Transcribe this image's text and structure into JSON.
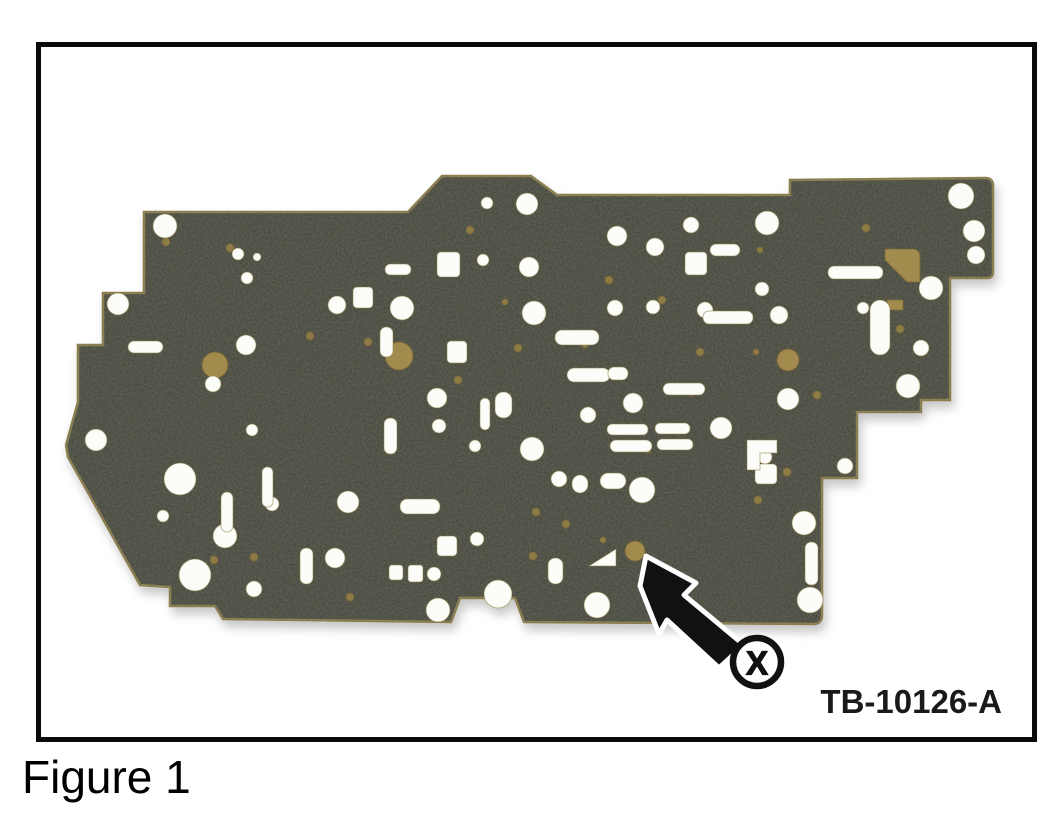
{
  "figure": {
    "caption": "Figure 1",
    "reference": "TB-10126-A"
  },
  "colors": {
    "background": "#ffffff",
    "frame": "#0a0a0a",
    "plate": "#42433a",
    "plate_edge": "#8a7c4b",
    "hole_fill": "#fcfcf9",
    "hole_stroke": "#8c7d46",
    "gold": "#a28c4d",
    "gold_dark": "#77663a",
    "gold_dot": "#8f7c45",
    "callout": "#111111",
    "callout_outline": "#ffffff"
  },
  "plate": {
    "outline": "M144,212 L408,212 L442,176 L531,176 L557,195 L790,195 L790,180 L985,178 Q993,178 993,186 L993,272 Q993,278 987,278 L950,278 L950,400 L921,400 L921,412 L857,412 L857,478 L822,478 L822,615 Q822,624 813,624 L524,622 L515,598 L460,598 L451,622 L223,619 L215,606 L170,606 L170,587 L140,585 L68,457 L66,445 L78,402 L78,345 L103,345 L103,293 L144,293 Z",
    "white_circles": [
      [
        165,
        226,
        12
      ],
      [
        118,
        304,
        11
      ],
      [
        96,
        440,
        11
      ],
      [
        246,
        345,
        10
      ],
      [
        213,
        384,
        8
      ],
      [
        238,
        254,
        6
      ],
      [
        257,
        257,
        4
      ],
      [
        247,
        278,
        6
      ],
      [
        337,
        305,
        9
      ],
      [
        402,
        308,
        12
      ],
      [
        487,
        203,
        6
      ],
      [
        527,
        204,
        11
      ],
      [
        534,
        313,
        12
      ],
      [
        483,
        260,
        6
      ],
      [
        529,
        267,
        10
      ],
      [
        617,
        236,
        10
      ],
      [
        655,
        247,
        9
      ],
      [
        691,
        225,
        8
      ],
      [
        767,
        223,
        12
      ],
      [
        762,
        289,
        7
      ],
      [
        779,
        315,
        9
      ],
      [
        863,
        308,
        6
      ],
      [
        921,
        348,
        8
      ],
      [
        961,
        196,
        13
      ],
      [
        974,
        231,
        11
      ],
      [
        976,
        255,
        9
      ],
      [
        931,
        288,
        12
      ],
      [
        908,
        386,
        12
      ],
      [
        788,
        399,
        11
      ],
      [
        845,
        466,
        8
      ],
      [
        804,
        523,
        12
      ],
      [
        810,
        600,
        13
      ],
      [
        437,
        398,
        10
      ],
      [
        439,
        426,
        7
      ],
      [
        475,
        446,
        6
      ],
      [
        588,
        415,
        8
      ],
      [
        633,
        403,
        10
      ],
      [
        653,
        307,
        7
      ],
      [
        705,
        310,
        8
      ],
      [
        615,
        308,
        8
      ],
      [
        532,
        449,
        12
      ],
      [
        559,
        479,
        8
      ],
      [
        642,
        490,
        13
      ],
      [
        721,
        428,
        11
      ],
      [
        765,
        457,
        7
      ],
      [
        180,
        479,
        16
      ],
      [
        195,
        575,
        16
      ],
      [
        225,
        536,
        12
      ],
      [
        272,
        504,
        7
      ],
      [
        335,
        558,
        10
      ],
      [
        348,
        502,
        11
      ],
      [
        252,
        430,
        6
      ],
      [
        163,
        516,
        6
      ],
      [
        254,
        589,
        8
      ],
      [
        498,
        594,
        14
      ],
      [
        438,
        610,
        12
      ],
      [
        597,
        605,
        13
      ],
      [
        477,
        539,
        7
      ],
      [
        434,
        574,
        7
      ]
    ],
    "slots": [
      [
        710,
        244,
        30,
        12,
        6
      ],
      [
        828,
        266,
        55,
        13,
        6
      ],
      [
        703,
        311,
        50,
        13,
        6
      ],
      [
        555,
        330,
        44,
        15,
        7
      ],
      [
        567,
        368,
        43,
        14,
        7
      ],
      [
        608,
        367,
        20,
        13,
        6
      ],
      [
        663,
        383,
        42,
        12,
        6
      ],
      [
        607,
        424,
        41,
        11,
        5
      ],
      [
        655,
        423,
        35,
        11,
        5
      ],
      [
        610,
        440,
        42,
        12,
        6
      ],
      [
        657,
        439,
        36,
        11,
        5
      ],
      [
        495,
        392,
        17,
        26,
        8
      ],
      [
        480,
        398,
        10,
        32,
        5
      ],
      [
        384,
        418,
        13,
        36,
        6
      ],
      [
        380,
        327,
        13,
        30,
        6
      ],
      [
        400,
        499,
        40,
        15,
        7
      ],
      [
        221,
        492,
        12,
        40,
        6
      ],
      [
        262,
        467,
        11,
        40,
        5
      ],
      [
        300,
        548,
        13,
        36,
        6
      ],
      [
        128,
        341,
        35,
        12,
        6
      ],
      [
        805,
        542,
        13,
        43,
        6
      ],
      [
        870,
        300,
        20,
        55,
        10
      ],
      [
        548,
        558,
        15,
        26,
        7
      ],
      [
        385,
        264,
        26,
        11,
        5
      ],
      [
        572,
        475,
        16,
        18,
        8
      ],
      [
        600,
        473,
        26,
        16,
        8
      ]
    ],
    "squares": [
      [
        437,
        252,
        23,
        25,
        4
      ],
      [
        685,
        252,
        22,
        23,
        4
      ],
      [
        353,
        287,
        20,
        21,
        4
      ],
      [
        447,
        341,
        20,
        22,
        4
      ],
      [
        755,
        464,
        22,
        20,
        4
      ],
      [
        437,
        536,
        20,
        20,
        4
      ],
      [
        389,
        565,
        14,
        15,
        3
      ],
      [
        408,
        565,
        15,
        17,
        3
      ]
    ],
    "white_paths": [
      "M747,440 h30 v13 h-17 v17 h-13 z",
      "M589,566 l27,-17 v17 z"
    ],
    "gold_circles": [
      [
        215,
        365,
        13
      ],
      [
        399,
        356,
        14
      ],
      [
        788,
        360,
        11
      ],
      [
        635,
        551,
        10
      ]
    ],
    "gold_patches": [
      "M885,249 h27 q8,0 8,8 v25 h-13 l-22,-22 z",
      "M887,300 h16 v10 h-16 z",
      "M450,350 h13 v13 h-13 z"
    ],
    "gold_dots": [
      [
        166,
        242,
        4
      ],
      [
        230,
        248,
        4
      ],
      [
        310,
        336,
        4
      ],
      [
        368,
        342,
        4
      ],
      [
        458,
        380,
        4
      ],
      [
        518,
        348,
        4
      ],
      [
        470,
        230,
        4
      ],
      [
        609,
        280,
        4
      ],
      [
        662,
        300,
        4
      ],
      [
        760,
        250,
        3
      ],
      [
        866,
        228,
        4
      ],
      [
        700,
        352,
        4
      ],
      [
        756,
        352,
        3
      ],
      [
        692,
        392,
        4
      ],
      [
        536,
        512,
        4
      ],
      [
        566,
        524,
        4
      ],
      [
        758,
        500,
        4
      ],
      [
        787,
        472,
        4
      ],
      [
        817,
        395,
        4
      ],
      [
        254,
        557,
        4
      ],
      [
        214,
        560,
        4
      ],
      [
        350,
        597,
        4
      ],
      [
        533,
        556,
        4
      ],
      [
        603,
        540,
        3
      ],
      [
        648,
        450,
        3
      ],
      [
        900,
        329,
        4
      ],
      [
        585,
        345,
        3
      ],
      [
        505,
        302,
        3
      ]
    ]
  },
  "callout": {
    "label": "X",
    "arrow_points": "646,556 696,583 684,595 744,645 719,668 667,620 659,634 640,586",
    "circle": {
      "cx": 757,
      "cy": 662,
      "r": 24
    }
  }
}
